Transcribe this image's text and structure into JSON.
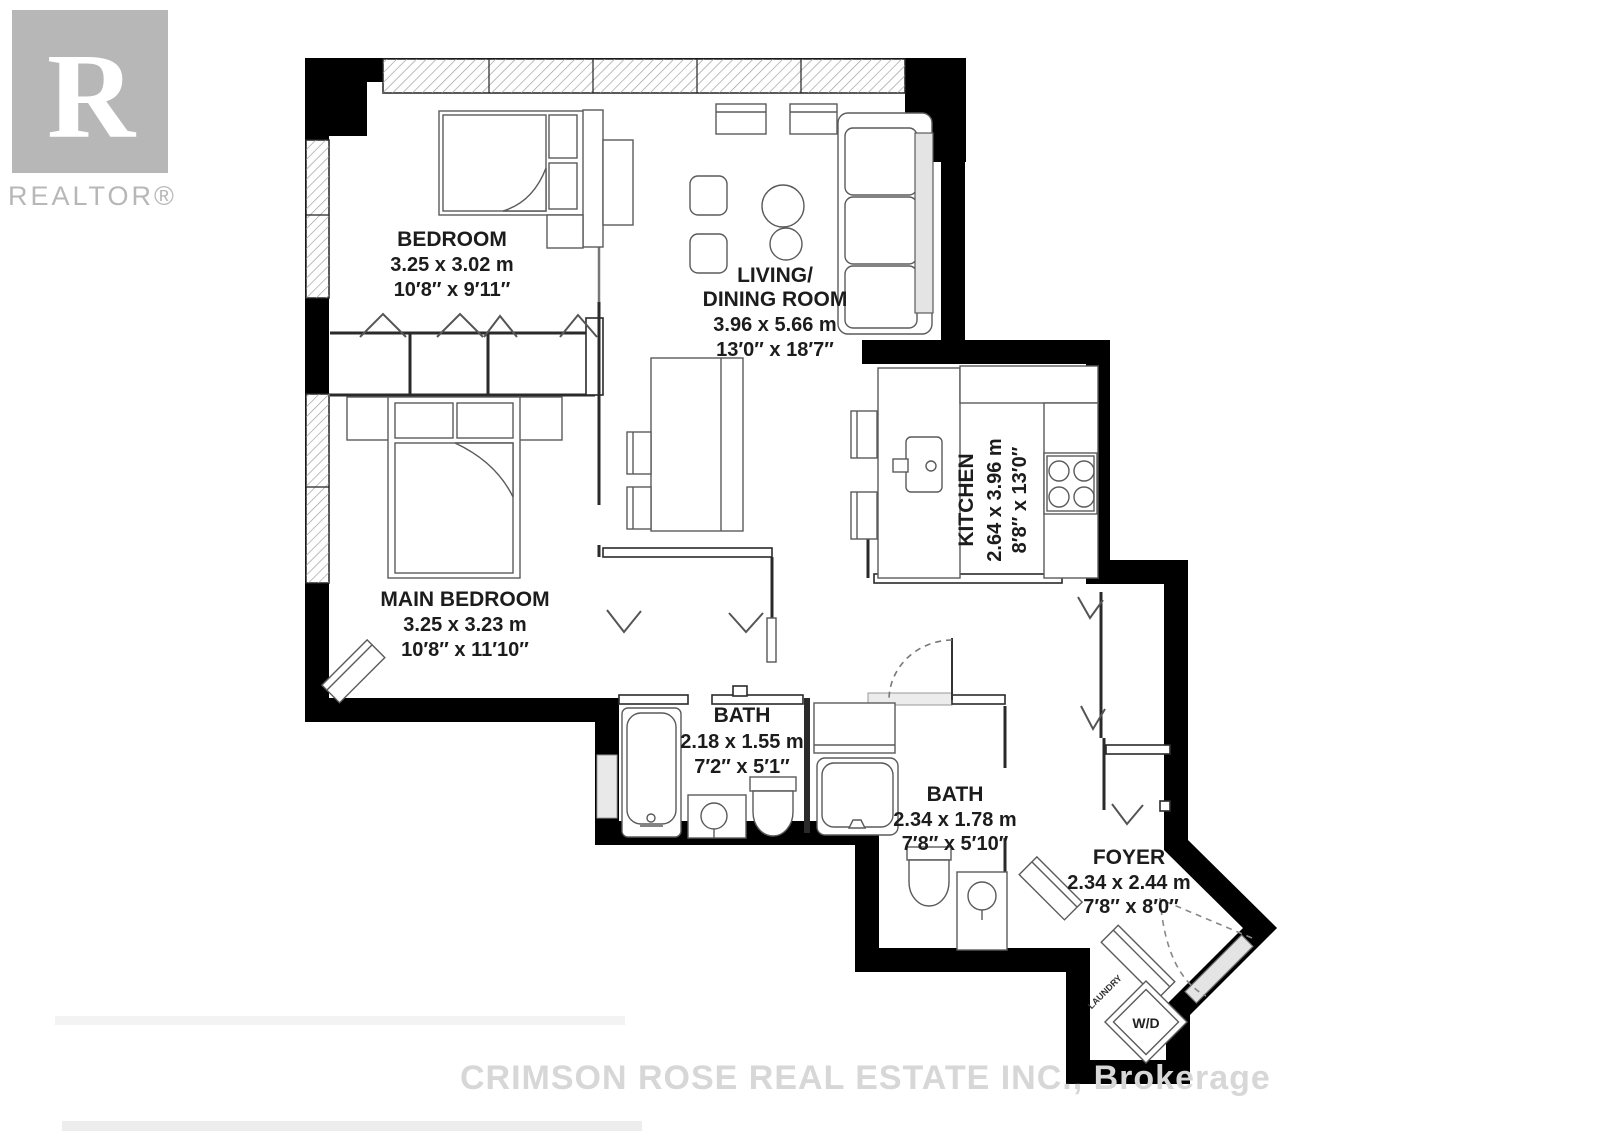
{
  "branding": {
    "logo_letter": "R",
    "logo_label": "REALTOR®"
  },
  "watermark": "CRIMSON ROSE REAL ESTATE INC., Brokerage",
  "rooms": {
    "bedroom": {
      "name": "BEDROOM",
      "metric": "3.25 x 3.02 m",
      "imperial": "10′8″ x 9′11″"
    },
    "living_dining": {
      "name_line1": "LIVING/",
      "name_line2": "DINING ROOM",
      "metric": "3.96 x 5.66 m",
      "imperial": "13′0″ x 18′7″"
    },
    "main_bedroom": {
      "name": "MAIN BEDROOM",
      "metric": "3.25 x 3.23 m",
      "imperial": "10′8″ x 11′10″"
    },
    "kitchen": {
      "name": "KITCHEN",
      "metric": "2.64 x 3.96 m",
      "imperial": "8′8″ x 13′0″"
    },
    "bath1": {
      "name": "BATH",
      "metric": "2.18 x 1.55 m",
      "imperial": "7′2″ x 5′1″"
    },
    "bath2": {
      "name": "BATH",
      "metric": "2.34 x 1.78 m",
      "imperial": "7′8″ x 5′10″"
    },
    "foyer": {
      "name": "FOYER",
      "metric": "2.34 x 2.44 m",
      "imperial": "7′8″ x 8′0″"
    }
  },
  "laundry": {
    "area_label": "LAUNDRY",
    "appliance_label": "W/D"
  },
  "colors": {
    "wall": "#000000",
    "watermark_gray": "#d7d7d7",
    "logo_gray": "#b7b7b7",
    "window_hatch": "#9a9a9a",
    "furniture_line": "#5a5a5a",
    "door_slab": "#e4e4e4"
  }
}
